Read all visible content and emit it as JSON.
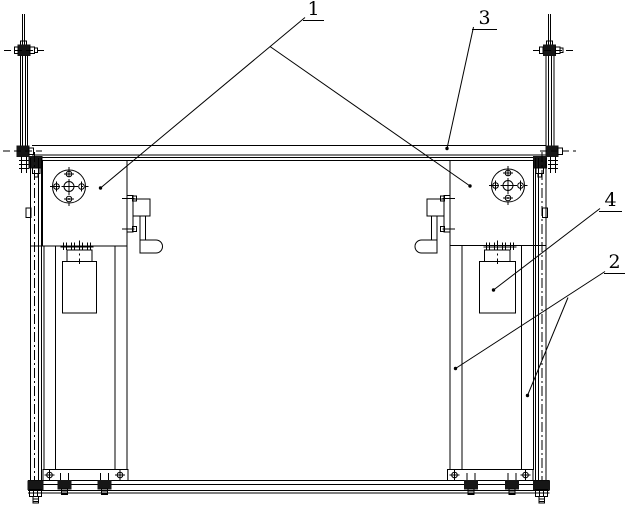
{
  "callouts": {
    "c1": "1",
    "c2": "2",
    "c3": "3",
    "c4": "4"
  },
  "colors": {
    "line": "#000000",
    "background": "#ffffff",
    "dark_fill": "#161616"
  }
}
